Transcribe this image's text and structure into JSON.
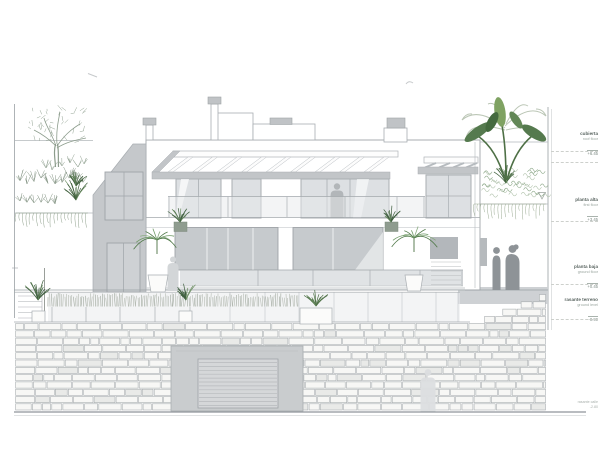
{
  "drawing_title": "south elevation - villa",
  "levels": [
    {
      "name": "cubierta",
      "sub": "roof floor",
      "elev": "+6.45"
    },
    {
      "name": "planta alta",
      "sub": "first floor",
      "elev": "+3.45"
    },
    {
      "name": "planta baja",
      "sub": "ground floor",
      "elev": "+0.45"
    },
    {
      "name": "rasante terreno",
      "sub": "ground level",
      "elev": "-0.90"
    }
  ],
  "ground_note": {
    "line1": "rasante calle",
    "line2": "-2.80"
  },
  "colors": {
    "line": "#a8adb1",
    "wall_shade": "#c5c8cb",
    "glass_light": "#dde0e3",
    "glass_dark": "#c6cacd",
    "fascia": "#c2c5c8",
    "stone_line": "#a3a8ab",
    "figure": "#8e9397",
    "plant_dark": "#40603d",
    "plant_mid": "#567f4f",
    "plant_light": "#93a393"
  }
}
